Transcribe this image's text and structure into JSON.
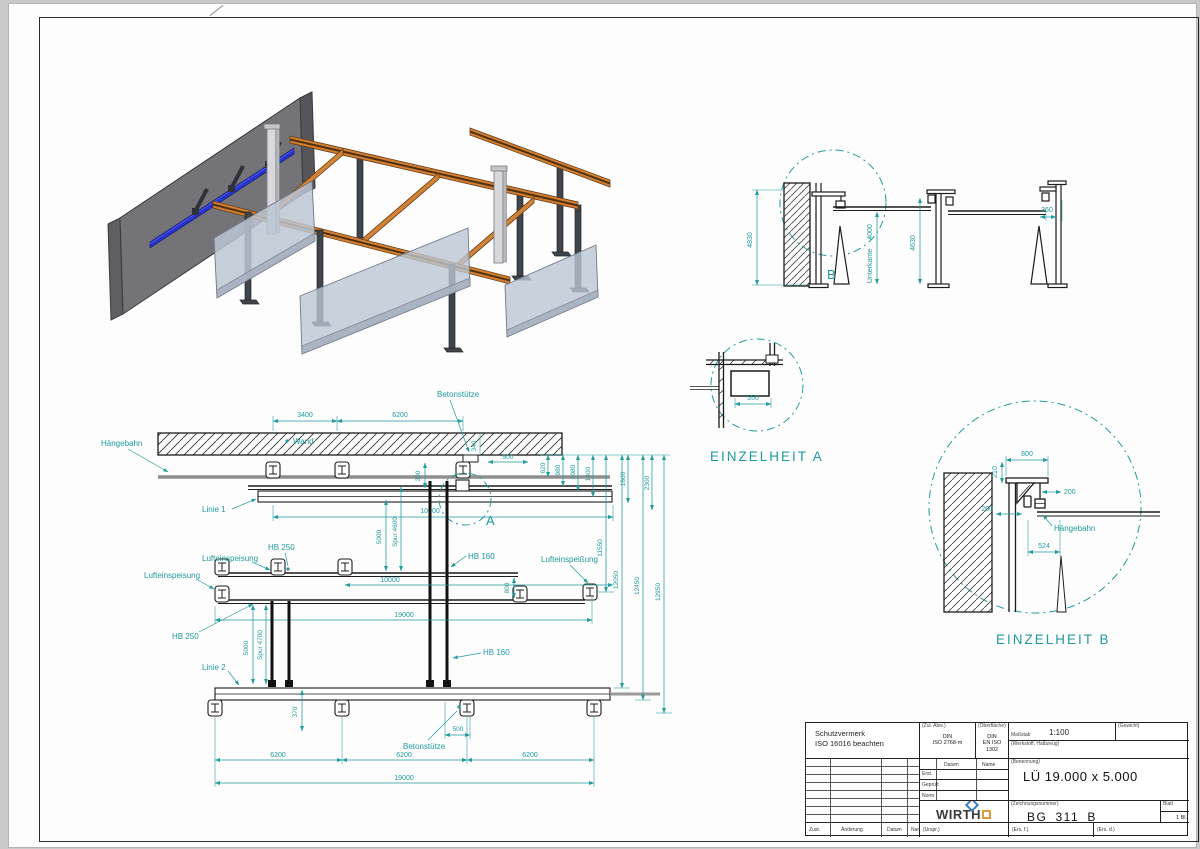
{
  "meta": {
    "accent_teal": "#1f9b9d",
    "line_color": "#1c1c1c",
    "background_color": "#c9c9c9",
    "beam_orange": "#d08036",
    "rail_blue": "#2633cc"
  },
  "section_view": {
    "dim_4830": "4830",
    "dim_unterkante": "Unterkante",
    "dim_4000": "4000",
    "dim_4630": "4630",
    "dim_360": "360",
    "detail_mark": "B"
  },
  "detail_a": {
    "title": "EINZELHEIT A",
    "dim_550": "550"
  },
  "detail_b": {
    "title": "EINZELHEIT B",
    "dim_800": "800",
    "dim_210": "210",
    "dim_200_right": "200",
    "dim_200_left": "200",
    "dim_524": "524",
    "label_haengebahn": "Hängebahn"
  },
  "plan": {
    "label_haengebahn": "Hängebahn",
    "label_wand": "Wand",
    "label_betonstuetze_top": "Betonstütze",
    "label_betonstuetze_bottom": "Betonstütze",
    "label_linie1": "Linie 1",
    "label_linie2": "Linie 2",
    "label_luft_1": "Lufteinspeisung",
    "label_luft_2": "Lufteinspeisung",
    "label_luft_3": "Lufteinspeißung",
    "label_hb250_1": "HB 250",
    "label_hb250_2": "HB 250",
    "label_hb160_1": "HB 160",
    "label_hb160_2": "HB 160",
    "detail_mark": "A",
    "dim_3400": "3400",
    "dim_6200_top": "6200",
    "dim_500_top": "500",
    "dim_340": "340",
    "dim_300": "300",
    "dim_620": "620",
    "dim_980": "980",
    "dim_1080": "1080",
    "dim_1400": "1400",
    "dim_1800": "1800",
    "dim_2300": "2300",
    "dim_10000_1": "10000",
    "dim_10000_2": "10000",
    "dim_5000_1": "5000",
    "dim_spur4600": "Spur 4600",
    "dim_5000_2": "5000",
    "dim_spur4700": "Spur 4700",
    "dim_800": "800",
    "dim_19000_1": "19000",
    "dim_19000_2": "19000",
    "dim_11550": "11550",
    "dim_12050": "12050",
    "dim_12450": "12450",
    "dim_12950": "12950",
    "dim_370": "370",
    "dim_500_bottom": "500",
    "dim_6200_a": "6200",
    "dim_6200_b": "6200",
    "dim_6200_c": "6200"
  },
  "title_block": {
    "schutzvermerk_line1": "Schutzvermerk",
    "schutzvermerk_line2": "ISO 16016 beachten",
    "zul_abw_header": "(Zul. Abw.)",
    "zul_abw_value1": "DIN",
    "zul_abw_value2": "ISO 2768-m",
    "oberflaeche_header": "(Oberfläche)",
    "oberflaeche_value1": "DIN",
    "oberflaeche_value2": "EN ISO 1302",
    "massstab_header": "Maßstab",
    "massstab_value": "1:100",
    "gewicht_header": "(Gewicht)",
    "werkstoff_header": "(Werkstoff, Halbzeug)",
    "datum_header": "Datum",
    "name_header": "Name",
    "row_erst": "Erst.",
    "row_geprueft": "Geprüft",
    "row_norm": "Norm",
    "benennung_header": "(Benennung)",
    "benennung_value": "LÜ 19.000 x 5.000",
    "company_left": "WIRTH",
    "company_right": "GMBH",
    "zeichnungsnummer_header": "(Zeichnungsnummer)",
    "zeichnungsnummer_value": "BG_311_B",
    "blatt_header": "Blatt",
    "blatt_value": "1 Bl.",
    "zust": "Zust.",
    "aenderung": "Änderung",
    "datum2": "Datum",
    "name2": "Name",
    "urspr": "(Urspr.)",
    "ers_f": "(Ers. f.)",
    "ers_d": "(Ers. d.)"
  }
}
